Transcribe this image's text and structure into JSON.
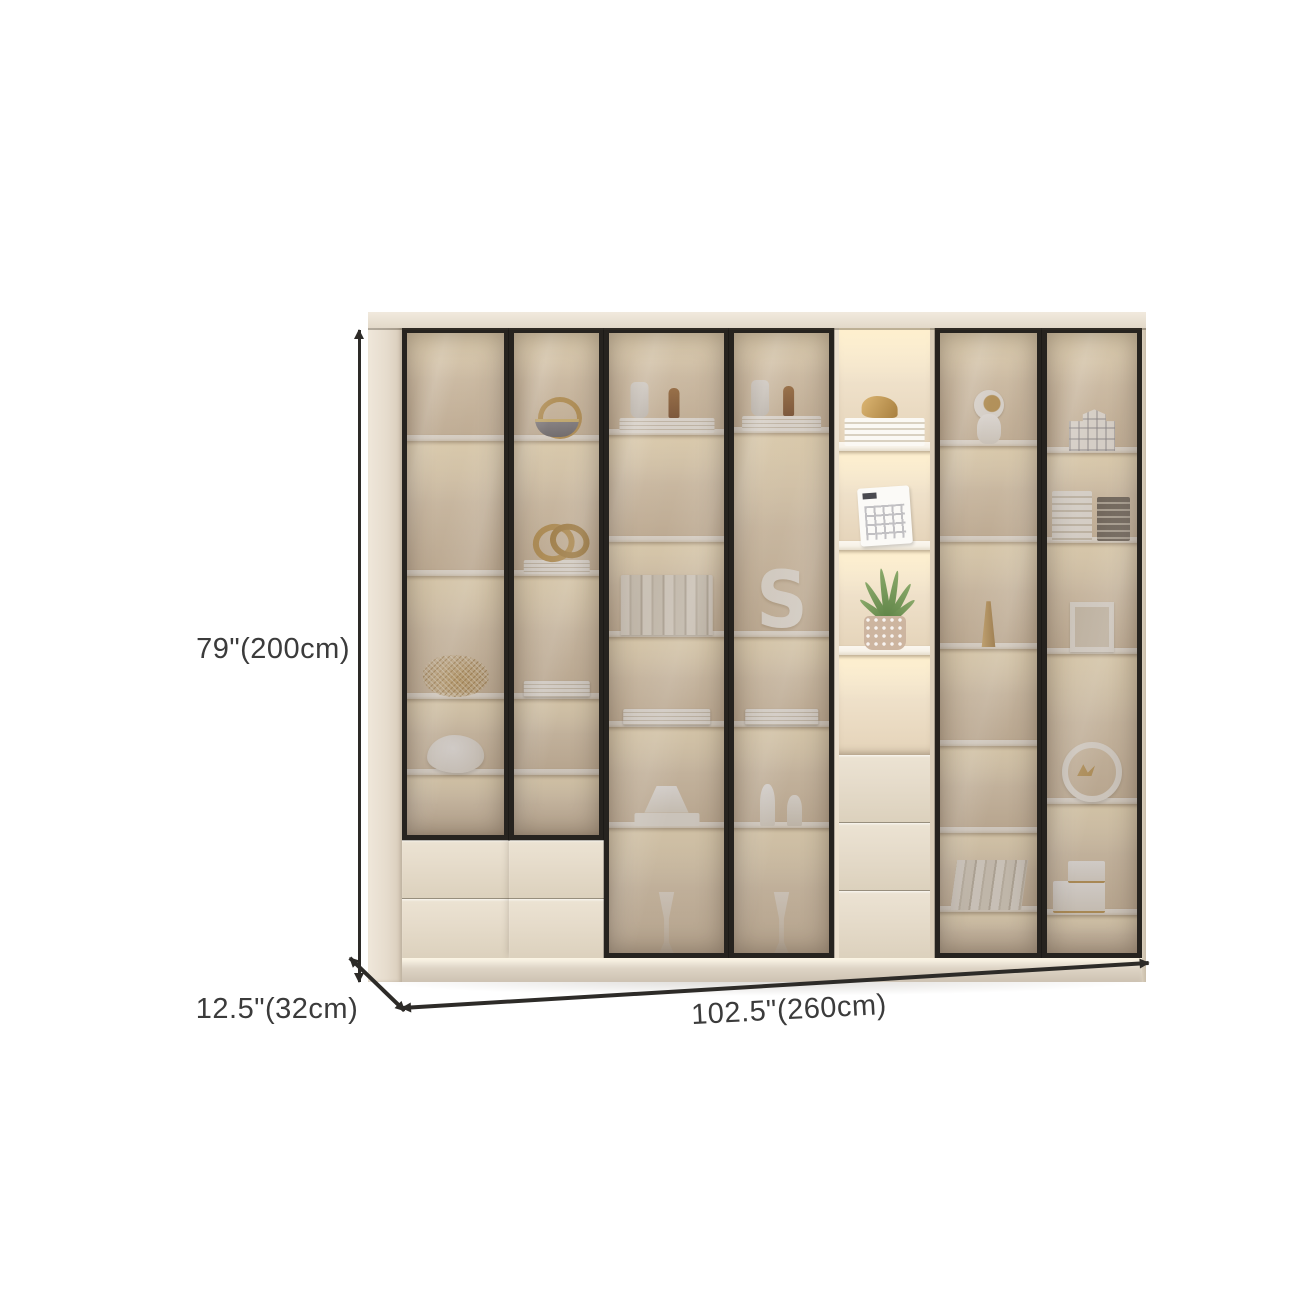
{
  "page": {
    "background": "#ffffff",
    "width": 1300,
    "height": 1300
  },
  "annotations": {
    "height_label": "79\"(200cm)",
    "depth_label": "12.5\"(32cm)",
    "width_label": "102.5\"(260cm)",
    "line_color": "#2d2b28",
    "text_color": "#3b3b3b"
  },
  "cabinet": {
    "colors": {
      "body": "#e8dfd2",
      "side": "#e6dccd",
      "top_panel": "#f1eade",
      "frame": "#26231f",
      "shelf": "#f7f2e8",
      "drawer": "#e6dccb",
      "seam": "#978e7d",
      "base": "#ddd3c4",
      "glow": "#ffeecb",
      "interior_hi": "#f6e8cb",
      "interior_lo": "#d9c6ab",
      "glass": "rgba(104,88,76,0.33)",
      "accent_gold": "#c59e58",
      "plant_green": "#5d8245"
    },
    "sections": [
      {
        "id": "1",
        "width": 107,
        "door": "glass",
        "door_bottom": 0.812,
        "shelves": [
          0.18,
          0.393,
          0.589,
          0.709
        ],
        "items": [
          {
            "type": "sculpture",
            "comp": 2
          },
          {
            "type": "cushion",
            "comp": 3
          }
        ],
        "drawers": {
          "top": 0.812,
          "count": 2
        }
      },
      {
        "id": "2",
        "width": 95,
        "door": "glass",
        "door_bottom": 0.812,
        "shelves": [
          0.18,
          0.393,
          0.589,
          0.709
        ],
        "items": [
          {
            "type": "basket",
            "comp": 0
          },
          {
            "type": "knot-books",
            "comp": 1
          },
          {
            "type": "books-stack",
            "comp": 2
          }
        ],
        "drawers": {
          "top": 0.812,
          "count": 2
        }
      },
      {
        "id": "3",
        "width": 125,
        "door": "glass",
        "door_bottom": 1,
        "shelves": [
          0.17,
          0.339,
          0.49,
          0.634,
          0.793
        ],
        "items": [
          {
            "type": "vases-books",
            "comp": 0
          },
          {
            "type": "books-row",
            "comp": 2
          },
          {
            "type": "books-stack",
            "comp": 3
          },
          {
            "type": "tier",
            "comp": 4
          },
          {
            "type": "goblet",
            "comp": 5
          }
        ]
      },
      {
        "id": "4",
        "width": 105,
        "door": "glass",
        "door_bottom": 1,
        "shelves": [
          0.167,
          0.49,
          0.634,
          0.793
        ],
        "items": [
          {
            "type": "vases-books",
            "comp": 0
          },
          {
            "type": "squiggle",
            "comp": 1,
            "glyph": "S"
          },
          {
            "type": "books-stack",
            "comp": 2
          },
          {
            "type": "candles",
            "comp": 3
          },
          {
            "type": "goblet",
            "comp": 4
          }
        ]
      },
      {
        "id": "5",
        "width": 101,
        "door": "open",
        "shelves": [
          0.191,
          0.347,
          0.514
        ],
        "items": [
          {
            "type": "bird-books",
            "comp": 0
          },
          {
            "type": "calendar",
            "comp": 1
          },
          {
            "type": "plant",
            "comp": 2
          }
        ],
        "drawers": {
          "top": 0.677,
          "count": 3
        }
      },
      {
        "id": "6",
        "width": 107,
        "door": "glass",
        "door_bottom": 1,
        "shelves": [
          0.188,
          0.339,
          0.51,
          0.664,
          0.801,
          0.927
        ],
        "items": [
          {
            "type": "astronaut",
            "comp": 0
          },
          {
            "type": "vase-gold",
            "comp": 2
          },
          {
            "type": "books-lean",
            "comp": 5
          }
        ]
      },
      {
        "id": "7",
        "width": 100,
        "door": "glass",
        "door_bottom": 1,
        "shelves": [
          0.199,
          0.342,
          0.517,
          0.756,
          0.931
        ],
        "items": [
          {
            "type": "house",
            "comp": 0
          },
          {
            "type": "books-box",
            "comp": 1
          },
          {
            "type": "frame",
            "comp": 2
          },
          {
            "type": "ring",
            "comp": 3
          },
          {
            "type": "boxes",
            "comp": 4
          }
        ]
      }
    ]
  }
}
